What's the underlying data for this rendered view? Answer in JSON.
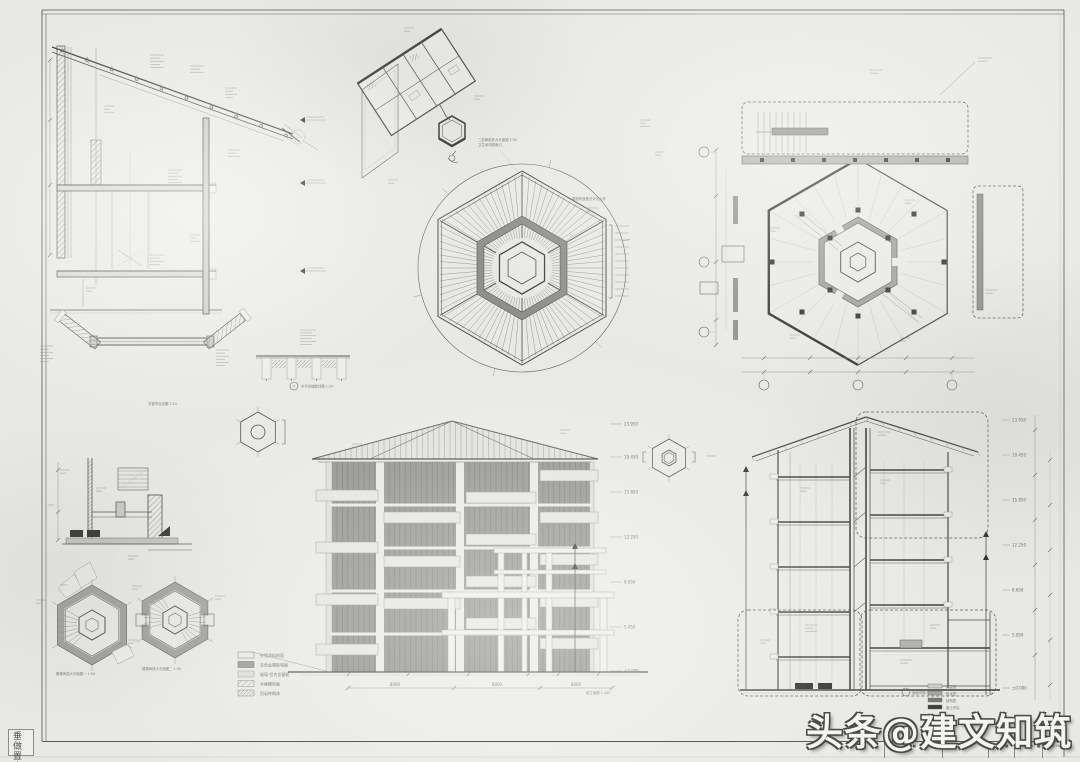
{
  "page": {
    "bg": "#e8e8e5",
    "line_dark": "#4a4a46",
    "line_light": "#b8b8b3",
    "panel_gray": "#8f8f8c",
    "paper_white": "#ececea"
  },
  "watermark": {
    "text": "头条@建文知筑"
  },
  "corner_stamp": {
    "text": "垂做置人"
  },
  "title_strip": {
    "fields": [
      {
        "label": "Project Title / ■"
      },
      {
        "label": "Drawn By / ■"
      },
      {
        "label": "Scale / ■"
      },
      {
        "label": "Checked / ■"
      },
      {
        "label": "DWG No. / ■"
      }
    ]
  },
  "captions": {
    "partial_plan_l1": "二层局部放大平面图 1:50",
    "partial_plan_l2": "卫生间详图索引",
    "roof_note": "屋面构造做法详见大样",
    "deck_detail": "木平台铺装详图 1:20",
    "deck_no": "7",
    "skylight": "天窗节点详图 1:15",
    "core_a": "楼梯间放大平面图一 1:50",
    "core_b": "楼梯间放大平面图二 1:50",
    "elevation": "剖立面图 1:100",
    "section": "剖面详图 1:50"
  },
  "legend_main": {
    "items": [
      {
        "swatch": "blank",
        "label": "外墙涂料饰面"
      },
      {
        "swatch": "solid",
        "label": "灰色金属板墙面"
      },
      {
        "swatch": "light",
        "label": "玻璃·铝合金窗框"
      },
      {
        "swatch": "hatch",
        "label": "木格栅饰面"
      },
      {
        "swatch": "hatch2",
        "label": "页岩砖砌体"
      }
    ]
  },
  "legend_section": {
    "items": [
      {
        "label": "保温层"
      },
      {
        "label": "防水层"
      },
      {
        "label": "结构层"
      },
      {
        "label": "素土夯实"
      }
    ]
  },
  "dims": {
    "elevation_bottom": [
      "8000",
      "8000",
      "8000"
    ],
    "levels": [
      "23.950",
      "19.450",
      "15.850",
      "12.250",
      "8.650",
      "5.050",
      "±0.000"
    ]
  }
}
